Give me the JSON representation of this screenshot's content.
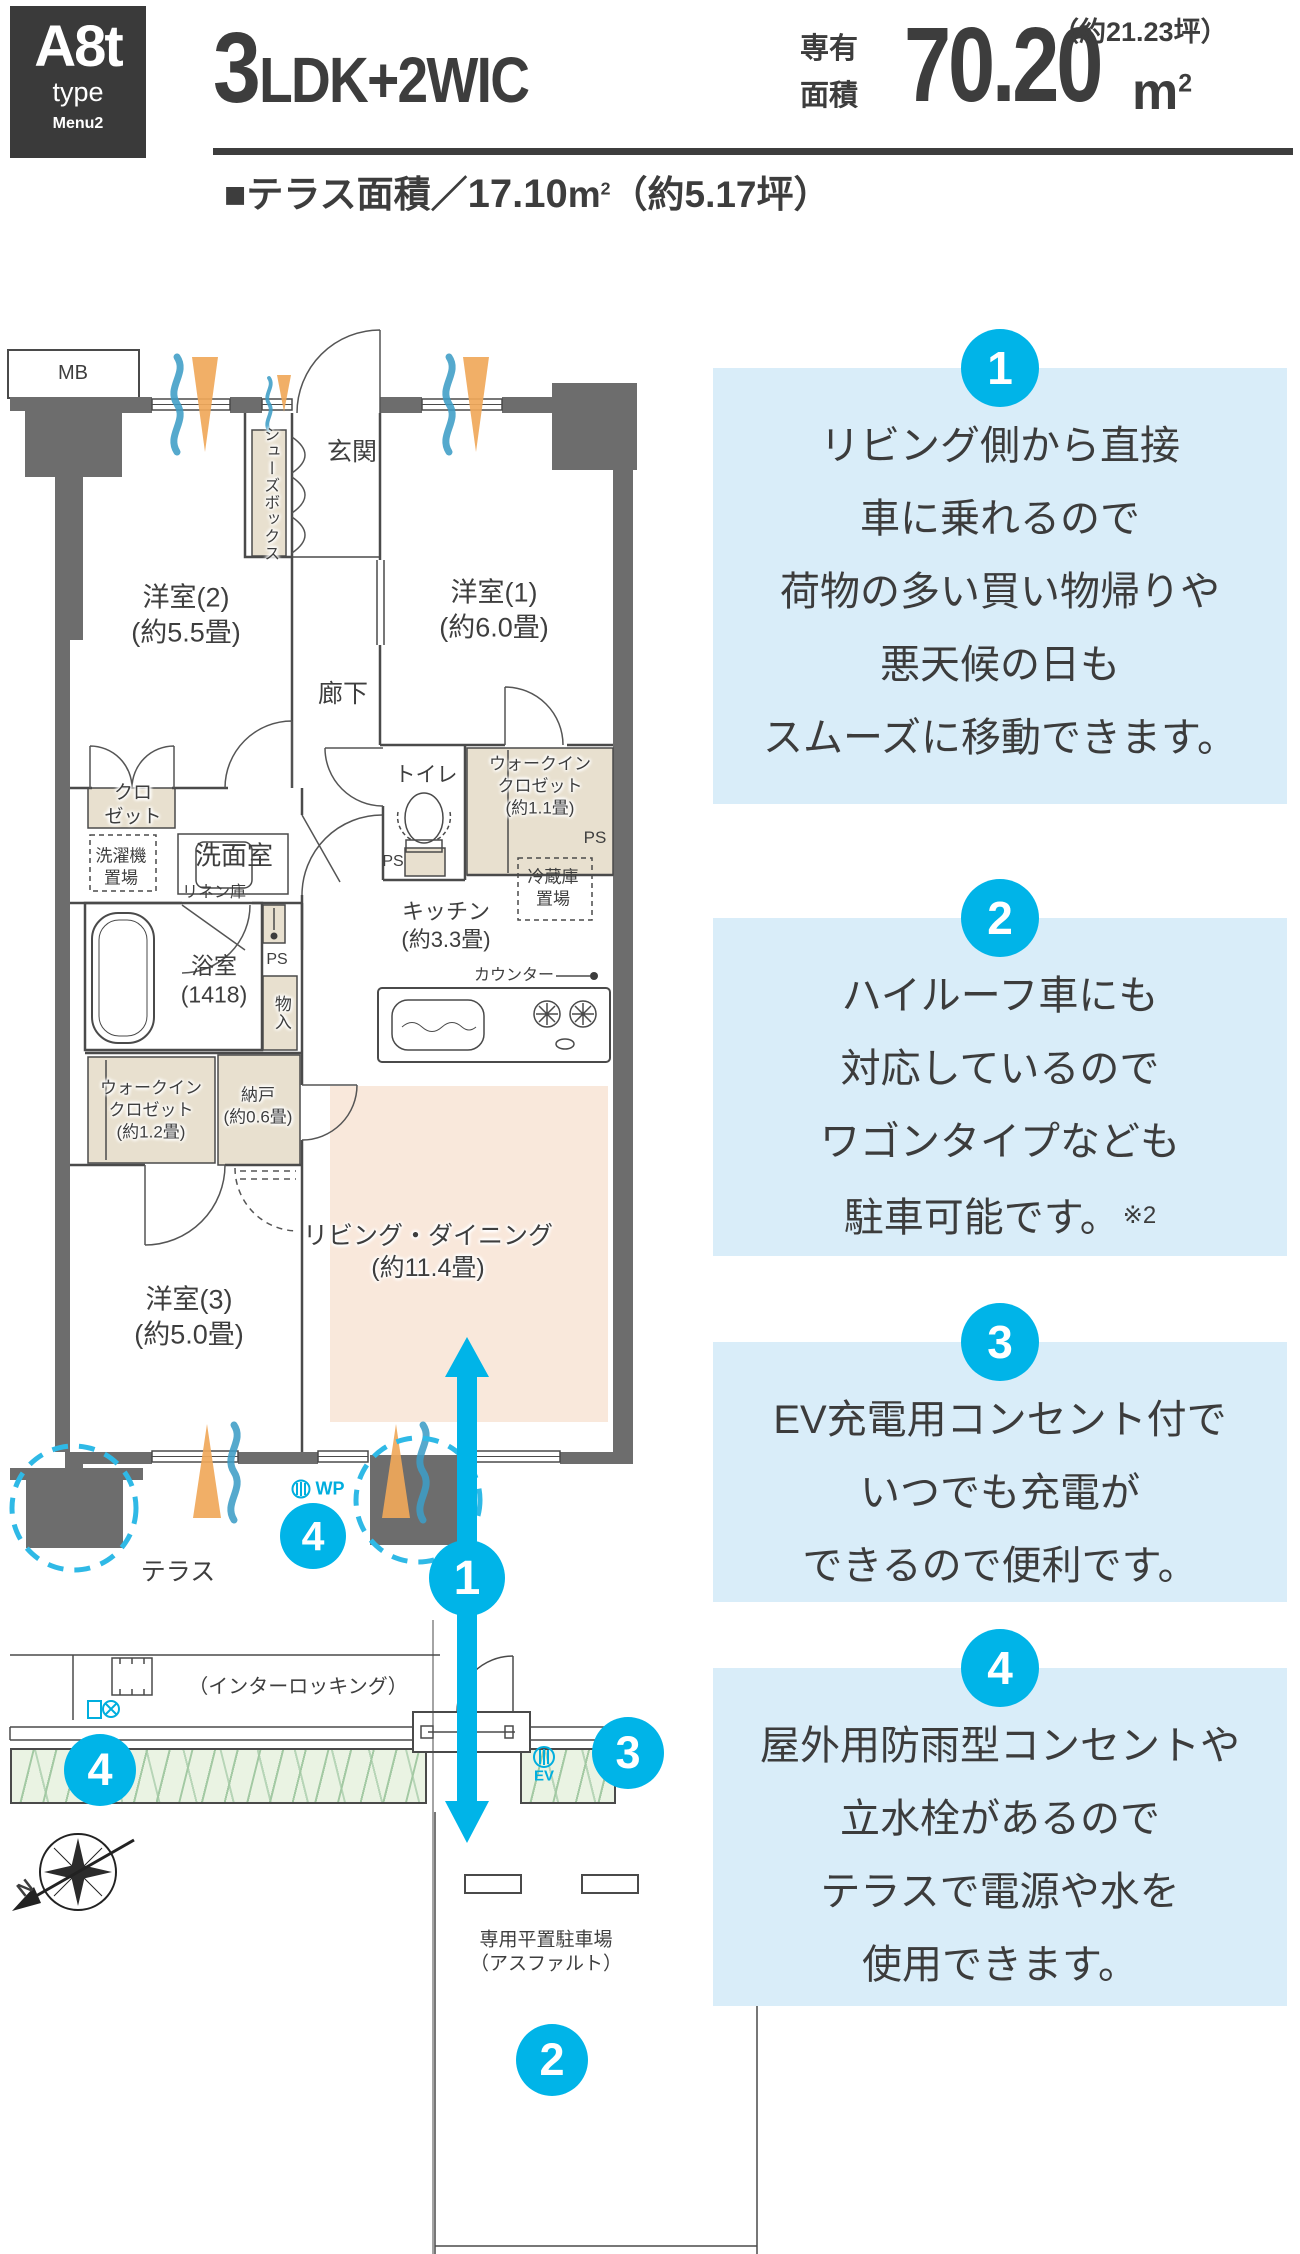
{
  "header": {
    "type_code": "A8t",
    "type_word": "type",
    "menu": "Menu2",
    "layout_big": "3",
    "layout_rest": "LDK+2WIC",
    "area_label_line1": "専有",
    "area_label_line2": "面積",
    "area_value": "70.20",
    "area_unit": "m",
    "area_unit_sup": "2",
    "area_tsubo": "（約21.23坪）",
    "terrace_prefix": "■テラス面積／",
    "terrace_value": "17.10",
    "terrace_unit": "m",
    "terrace_unit_sup": "2",
    "terrace_tsubo": "（約5.17坪）"
  },
  "colors": {
    "accent_cyan": "#00b4e8",
    "info_box_blue": "#d9edf9",
    "wall_gray": "#6d6d6d",
    "closet_beige": "#e8e0cf",
    "living_peach": "#f9e8db",
    "hedge_green": "#eaf3e3"
  },
  "plan": {
    "labels": [
      {
        "name": "mb-label",
        "x": 73,
        "y": 374,
        "size": 20,
        "lines": [
          "MB"
        ]
      },
      {
        "name": "genkan-label",
        "x": 352,
        "y": 452,
        "size": 25,
        "lines": [
          "玄関"
        ]
      },
      {
        "name": "shoebox-label",
        "x": 269,
        "y": 494,
        "size": 16,
        "cls": "vertical halo",
        "lines": [
          "シューズボックス"
        ]
      },
      {
        "name": "room1-label",
        "x": 494,
        "y": 610,
        "size": 27,
        "lines": [
          "洋室(1)",
          "(約6.0畳)"
        ]
      },
      {
        "name": "room2-label",
        "x": 186,
        "y": 615,
        "size": 27,
        "lines": [
          "洋室(2)",
          "(約5.5畳)"
        ]
      },
      {
        "name": "rouka-label",
        "x": 343,
        "y": 694,
        "size": 25,
        "lines": [
          "廊下"
        ]
      },
      {
        "name": "closet2-label",
        "x": 133,
        "y": 806,
        "size": 19,
        "cls": "halo",
        "lines": [
          "クロ",
          "ゼット"
        ]
      },
      {
        "name": "toilet-label",
        "x": 426,
        "y": 776,
        "size": 21,
        "lines": [
          "トイレ"
        ]
      },
      {
        "name": "wic11-label",
        "x": 540,
        "y": 786,
        "size": 17,
        "cls": "halo",
        "lines": [
          "ウォークイン",
          "クロゼット",
          "(約1.1畳)"
        ]
      },
      {
        "name": "ps-wic-label",
        "x": 595,
        "y": 838,
        "size": 17,
        "lines": [
          "PS"
        ]
      },
      {
        "name": "ps-toilet-label",
        "x": 393,
        "y": 862,
        "size": 16,
        "lines": [
          "PS"
        ]
      },
      {
        "name": "laundry-label",
        "x": 121,
        "y": 867,
        "size": 17,
        "lines": [
          "洗濯機",
          "置場"
        ]
      },
      {
        "name": "senmen-label",
        "x": 234,
        "y": 856,
        "size": 26,
        "lines": [
          "洗面室"
        ]
      },
      {
        "name": "linen-label",
        "x": 214,
        "y": 893,
        "size": 16,
        "lines": [
          "リネン庫"
        ]
      },
      {
        "name": "fridge-label",
        "x": 553,
        "y": 888,
        "size": 17,
        "lines": [
          "冷蔵庫",
          "置場"
        ]
      },
      {
        "name": "kitchen-label",
        "x": 446,
        "y": 926,
        "size": 22,
        "lines": [
          "キッチン",
          "(約3.3畳)"
        ]
      },
      {
        "name": "bath-label",
        "x": 214,
        "y": 981,
        "size": 23,
        "lines": [
          "浴室",
          "(1418)"
        ]
      },
      {
        "name": "ps-bath-label",
        "x": 277,
        "y": 960,
        "size": 16,
        "lines": [
          "PS"
        ]
      },
      {
        "name": "monoire-label",
        "x": 281,
        "y": 1013,
        "size": 17,
        "cls": "vertical halo",
        "lines": [
          "物入"
        ]
      },
      {
        "name": "counter-label",
        "x": 514,
        "y": 976,
        "size": 16,
        "lines": [
          "カウンター"
        ]
      },
      {
        "name": "wic12-label",
        "x": 151,
        "y": 1110,
        "size": 17,
        "cls": "halo",
        "lines": [
          "ウォークイン",
          "クロゼット",
          "(約1.2畳)"
        ]
      },
      {
        "name": "nando-label",
        "x": 258,
        "y": 1106,
        "size": 17,
        "cls": "halo",
        "lines": [
          "納戸",
          "(約0.6畳)"
        ]
      },
      {
        "name": "room3-label",
        "x": 189,
        "y": 1317,
        "size": 27,
        "lines": [
          "洋室(3)",
          "(約5.0畳)"
        ]
      },
      {
        "name": "ld-label",
        "x": 428,
        "y": 1252,
        "size": 25,
        "cls": "halo",
        "lines": [
          "リビング・ダイニング",
          "(約11.4畳)"
        ]
      },
      {
        "name": "terrace-label",
        "x": 178,
        "y": 1572,
        "size": 25,
        "lines": [
          "テラス"
        ]
      },
      {
        "name": "wp-label",
        "x": 330,
        "y": 1489,
        "size": 18,
        "cls": "cyan",
        "lines": [
          "WP"
        ]
      },
      {
        "name": "interlocking-label",
        "x": 298,
        "y": 1688,
        "size": 20,
        "lines": [
          "（インターロッキング）"
        ]
      },
      {
        "name": "ev-label",
        "x": 544,
        "y": 1776,
        "size": 15,
        "cls": "cyan",
        "lines": [
          "EV"
        ]
      },
      {
        "name": "parking-label",
        "x": 546,
        "y": 1953,
        "size": 19,
        "lines": [
          "専用平置駐車場",
          "（アスファルト）"
        ]
      },
      {
        "name": "compass-n-label",
        "x": 26,
        "y": 1889,
        "size": 20,
        "cls": "bold",
        "rot": -38,
        "lines": [
          "N"
        ]
      }
    ],
    "callouts": [
      {
        "n": "4",
        "x": 313,
        "y": 1536,
        "r": 33
      },
      {
        "n": "1",
        "x": 467,
        "y": 1578,
        "r": 38
      },
      {
        "n": "3",
        "x": 628,
        "y": 1753,
        "r": 36
      },
      {
        "n": "4",
        "x": 100,
        "y": 1770,
        "r": 36
      },
      {
        "n": "2",
        "x": 552,
        "y": 2060,
        "r": 36
      }
    ]
  },
  "aside": {
    "blocks": [
      {
        "number": "1",
        "top": 368,
        "height": 436,
        "lines": [
          "リビング側から直接",
          "車に乗れるので",
          "荷物の多い買い物帰りや",
          "悪天候の日も",
          "スムーズに移動できます。"
        ]
      },
      {
        "number": "2",
        "top": 918,
        "height": 338,
        "lines": [
          "ハイルーフ車にも",
          "対応しているので",
          "ワゴンタイプなども",
          "駐車可能です。"
        ],
        "note": "※2"
      },
      {
        "number": "3",
        "top": 1342,
        "height": 260,
        "lines": [
          "EV充電用コンセント付で",
          "いつでも充電が",
          "できるので便利です。"
        ]
      },
      {
        "number": "4",
        "top": 1668,
        "height": 338,
        "lines": [
          "屋外用防雨型コンセントや",
          "立水栓があるので",
          "テラスで電源や水を",
          "使用できます。"
        ]
      }
    ]
  }
}
